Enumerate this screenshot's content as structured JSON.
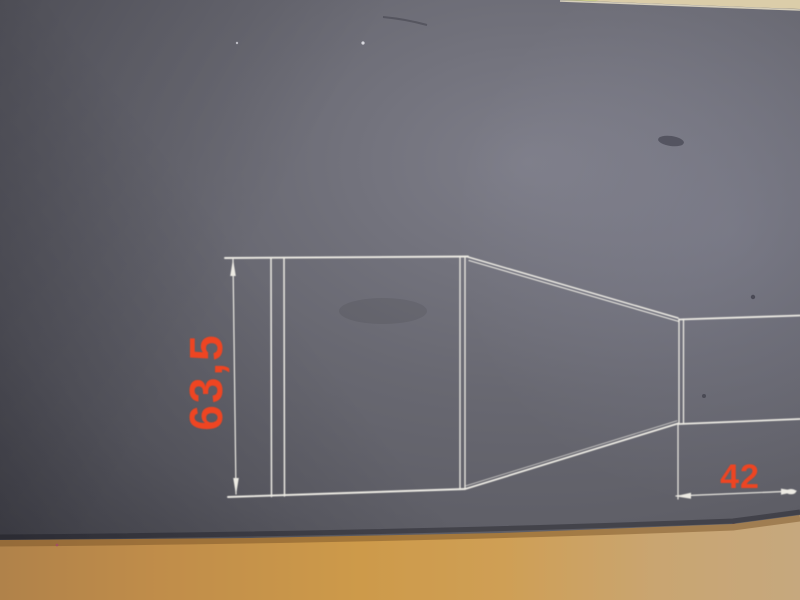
{
  "drawing": {
    "height_dimension": {
      "label": "63,5"
    },
    "width_dimension": {
      "label": "42"
    },
    "colors": {
      "dimension_text": "#ee4422",
      "line_white": "#edebe4",
      "sheet_gray_mid": "#686871",
      "sheet_gray_light": "#7d7d88",
      "sheet_gray_dark": "#4e4e55",
      "wood_tan": "#cd9a4a",
      "wood_left": "#b0824a",
      "wood_right": "#c6a87e",
      "top_strip_beige": "#dbcda9"
    }
  }
}
